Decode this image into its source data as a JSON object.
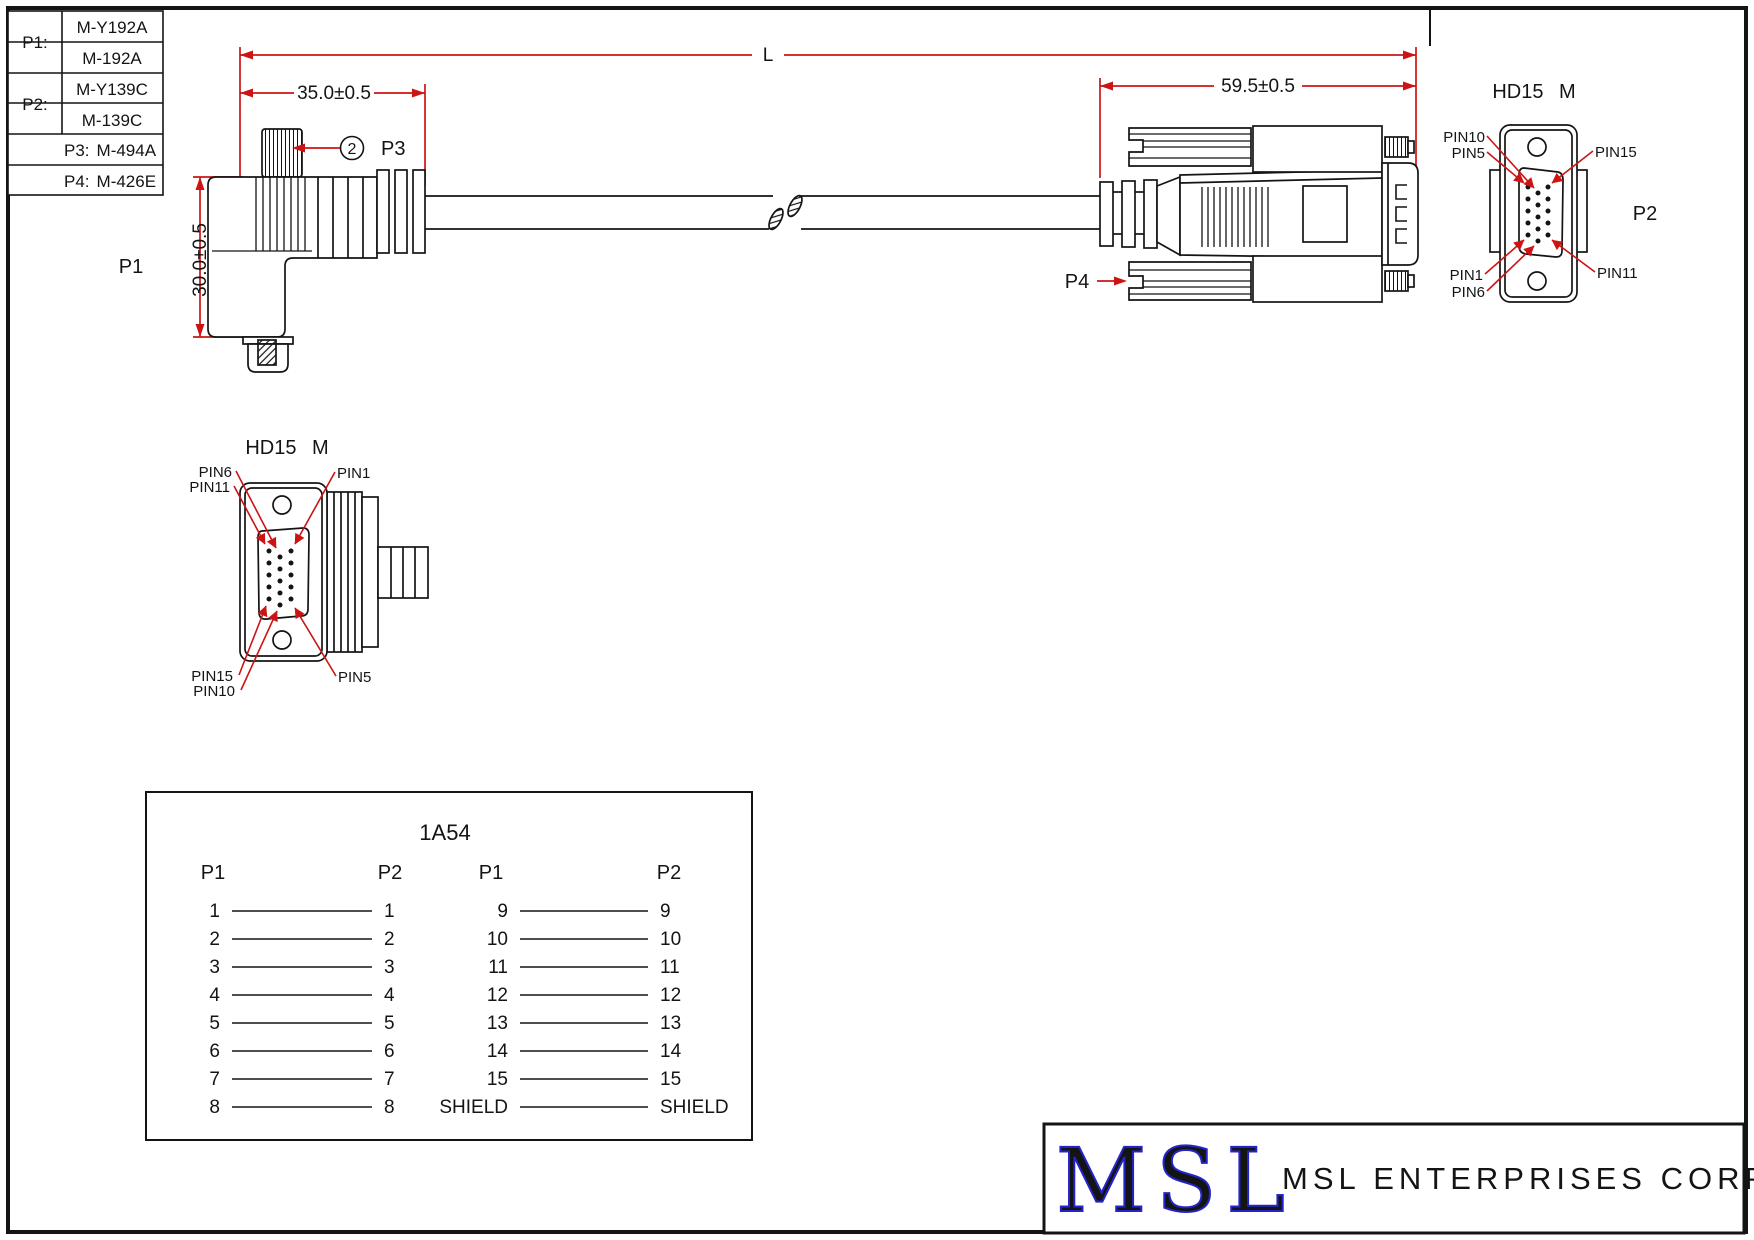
{
  "parts_table": {
    "rows": [
      {
        "label": "P1:",
        "values": [
          "M-Y192A",
          "M-192A"
        ]
      },
      {
        "label": "P2:",
        "values": [
          "M-Y139C",
          "M-139C"
        ]
      },
      {
        "label": "P3:",
        "values": [
          "M-494A"
        ]
      },
      {
        "label": "P4:",
        "values": [
          "M-426E"
        ]
      }
    ]
  },
  "dimensions": {
    "length": "L",
    "p1_offset": "35.0±0.5",
    "p2_offset": "59.5±0.5",
    "p1_height": "30.0±0.5"
  },
  "callouts": {
    "p1": "P1",
    "p2": "P2",
    "p3": "P3",
    "p3_qty": "2",
    "p4": "P4"
  },
  "connector_views": {
    "left": {
      "title": "HD15 M",
      "labels": [
        "PIN6",
        "PIN11",
        "PIN1",
        "PIN15",
        "PIN10",
        "PIN5"
      ]
    },
    "right": {
      "title": "HD15 M",
      "designator": "P2",
      "labels": [
        "PIN10",
        "PIN5",
        "PIN15",
        "PIN1",
        "PIN6",
        "PIN11"
      ]
    }
  },
  "wiring_diagram": {
    "title": "1A54",
    "groups": [
      {
        "header_left": "P1",
        "header_right": "P2",
        "rows": [
          [
            "1",
            "1"
          ],
          [
            "2",
            "2"
          ],
          [
            "3",
            "3"
          ],
          [
            "4",
            "4"
          ],
          [
            "5",
            "5"
          ],
          [
            "6",
            "6"
          ],
          [
            "7",
            "7"
          ],
          [
            "8",
            "8"
          ]
        ]
      },
      {
        "header_left": "P1",
        "header_right": "P2",
        "rows": [
          [
            "9",
            "9"
          ],
          [
            "10",
            "10"
          ],
          [
            "11",
            "11"
          ],
          [
            "12",
            "12"
          ],
          [
            "13",
            "13"
          ],
          [
            "14",
            "14"
          ],
          [
            "15",
            "15"
          ],
          [
            "SHIELD",
            "SHIELD"
          ]
        ]
      }
    ]
  },
  "title_block": {
    "logo": "MSL",
    "company": "MSL ENTERPRISES CORP."
  },
  "colors": {
    "dimension_red": "#cc1414",
    "logo_blue": "#2424cc",
    "line_black": "#141414"
  }
}
